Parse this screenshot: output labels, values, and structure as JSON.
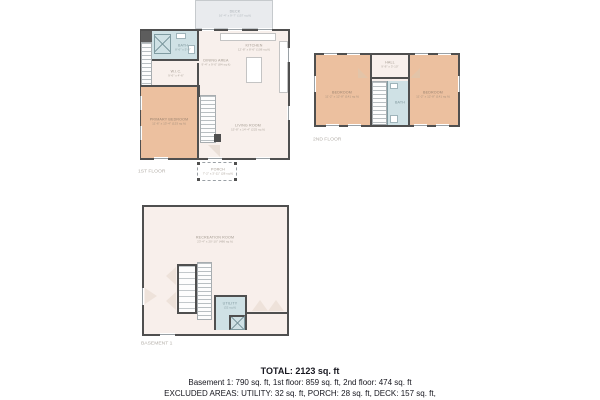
{
  "summary": {
    "total": "TOTAL: 2123 sq. ft",
    "floors": "Basement 1: 790 sq. ft, 1st floor: 859 sq. ft, 2nd floor: 474 sq. ft",
    "excluded": "EXCLUDED AREAS: UTILITY: 32 sq. ft, PORCH: 28 sq. ft, DECK: 157 sq. ft,",
    "excluded2": "WALLS: 166 sq. ft"
  },
  "colors": {
    "wall": "#4f4f4f",
    "floor_cream": "#f8f0ec",
    "bedroom_tan": "#ecc09f",
    "bath_blue": "#cfe1e5",
    "deck_gray": "#e9ebee"
  },
  "floor1": {
    "label": "1ST FLOOR",
    "rooms": {
      "deck": {
        "name": "DECK",
        "dims": "16'-4\" x 9'-7\" (157 sq ft)"
      },
      "kitchen": {
        "name": "KITCHEN",
        "dims": "12'-8\" x 8'-6\" (108 sq ft)"
      },
      "dining": {
        "name": "DINING AREA",
        "dims": "9'-4\" x 9'-0\" (84 sq ft)"
      },
      "living": {
        "name": "LIVING ROOM",
        "dims": "15'-8\" x 14'-4\" (225 sq ft)"
      },
      "primary": {
        "name": "PRIMARY BEDROOM",
        "dims": "11'-6\" x 13'-4\" (153 sq ft)"
      },
      "bath": {
        "name": "BATH",
        "dims": "8'-6\" x 5'-0\""
      },
      "wic": {
        "name": "W.I.C.",
        "dims": "9'-6\" x 4'-6\""
      },
      "porch": {
        "name": "PORCH",
        "dims": "7'-2\" x 3'-11\" (28 sq ft)"
      }
    }
  },
  "floor2": {
    "label": "2ND FLOOR",
    "rooms": {
      "bedroom_left": {
        "name": "BEDROOM",
        "dims": "11'-2\" x 12'-8\" (141 sq ft)"
      },
      "bedroom_right": {
        "name": "BEDROOM",
        "dims": "11'-2\" x 12'-8\" (141 sq ft)"
      },
      "hall": {
        "name": "HALL",
        "dims": "9'-8\" x 3'-10\""
      },
      "bath": {
        "name": "BATH"
      }
    }
  },
  "basement": {
    "label": "BASEMENT 1",
    "rooms": {
      "recreation": {
        "name": "RECREATION ROOM",
        "dims": "23'-4\" x 20'-10\" (486 sq ft)"
      },
      "utility": {
        "name": "UTILITY",
        "dims": "(32 sq ft)"
      }
    }
  }
}
